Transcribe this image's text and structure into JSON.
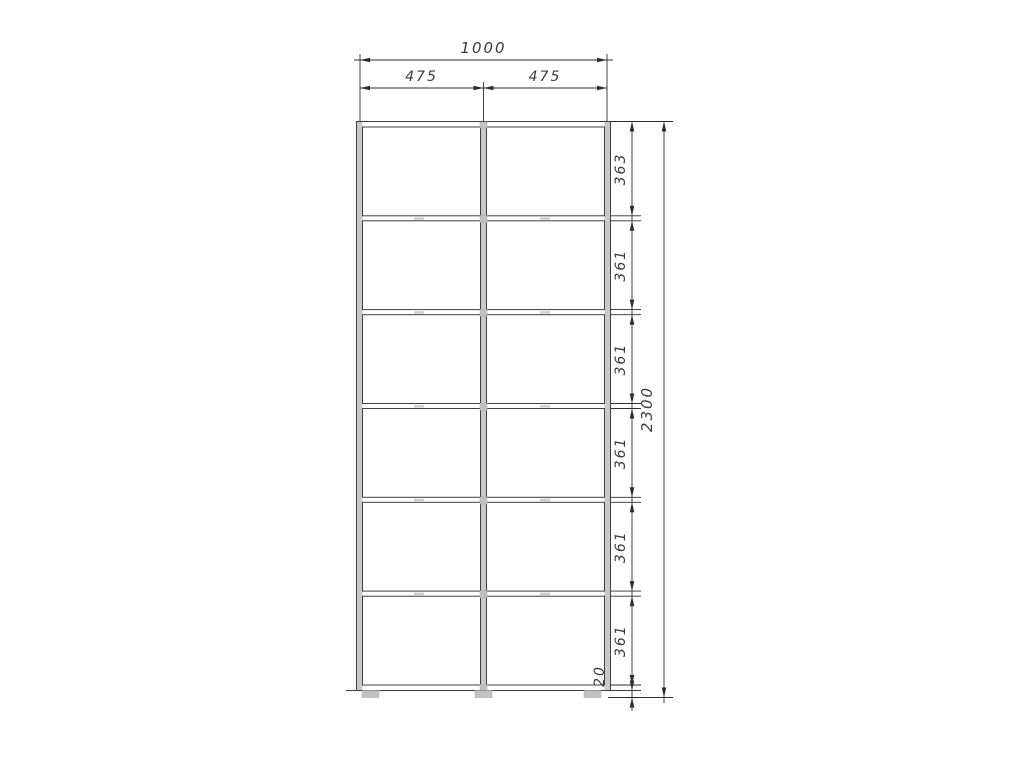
{
  "drawing": {
    "subject": "wardrobe-carcass-front-elevation",
    "grid": {
      "columns": 2,
      "rows": 6
    }
  },
  "dimensions": {
    "total_width": "1000",
    "columns": [
      "475",
      "475"
    ],
    "rows": [
      "363",
      "361",
      "361",
      "361",
      "361",
      "361"
    ],
    "plinth_height": "20",
    "total_height": "2300"
  },
  "colors": {
    "background": "#ffffff",
    "outline": "#3f3f3f",
    "dimension_line": "#2d2d2d",
    "panel_fill": "#c9c9c9",
    "text": "#3b3b3b"
  }
}
